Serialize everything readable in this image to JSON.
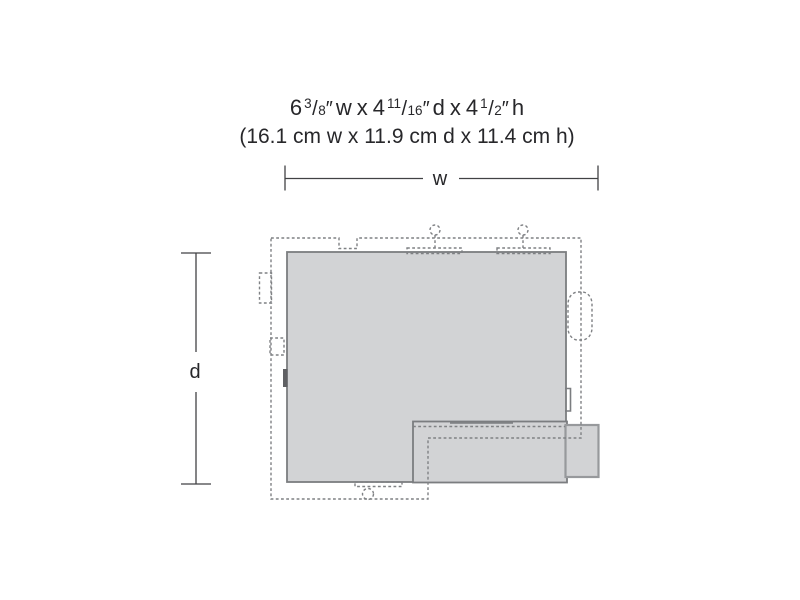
{
  "title": {
    "imperial": {
      "dims": [
        {
          "whole": "6",
          "num": "3",
          "den": "8",
          "unit": "w"
        },
        {
          "whole": "4",
          "num": "11",
          "den": "16",
          "unit": "d"
        },
        {
          "whole": "4",
          "num": "1",
          "den": "2",
          "unit": "h"
        }
      ],
      "sep": "x",
      "slash": "/",
      "inch_mark": "″"
    },
    "metric": "(16.1 cm w x 11.9 cm d x 11.4 cm h)"
  },
  "dimension_labels": {
    "width": "w",
    "depth": "d"
  },
  "colors": {
    "page-bg": "#ffffff",
    "footprint-fill": "#d2d3d5",
    "footprint-stroke": "#7b7d80",
    "block-stroke": "#97999c",
    "dash-stroke": "#7f8184",
    "dim-line": "#414244",
    "text-color": "#27272a",
    "door-fill": "#5f6063"
  }
}
